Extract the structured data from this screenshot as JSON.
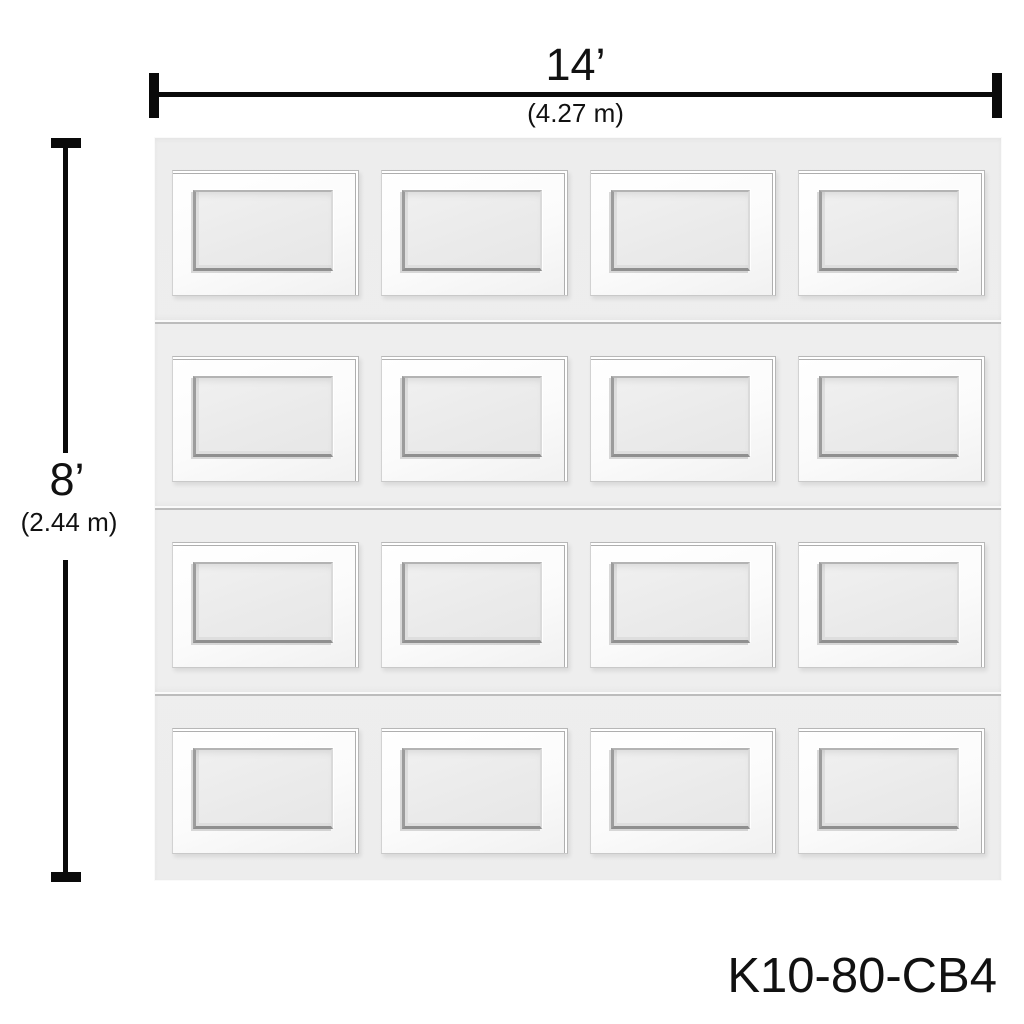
{
  "diagram": {
    "width_dimension": {
      "imperial": "14’",
      "metric": "(4.27 m)"
    },
    "height_dimension": {
      "imperial": "8’",
      "metric": "(2.44 m)"
    },
    "product_code": "K10-80-CB4",
    "door": {
      "type": "sectional-garage-door",
      "panel_style": "raised-panel",
      "sections": 4,
      "panels_per_section": 4
    },
    "colors": {
      "page_background": "#ffffff",
      "dimension": "#0a0a0a",
      "text": "#111111",
      "door_background": "#eeeeee",
      "panel_face": "#fbfbfb",
      "panel_recess": "#eaeaea",
      "seam": "#bcbcbc"
    }
  }
}
